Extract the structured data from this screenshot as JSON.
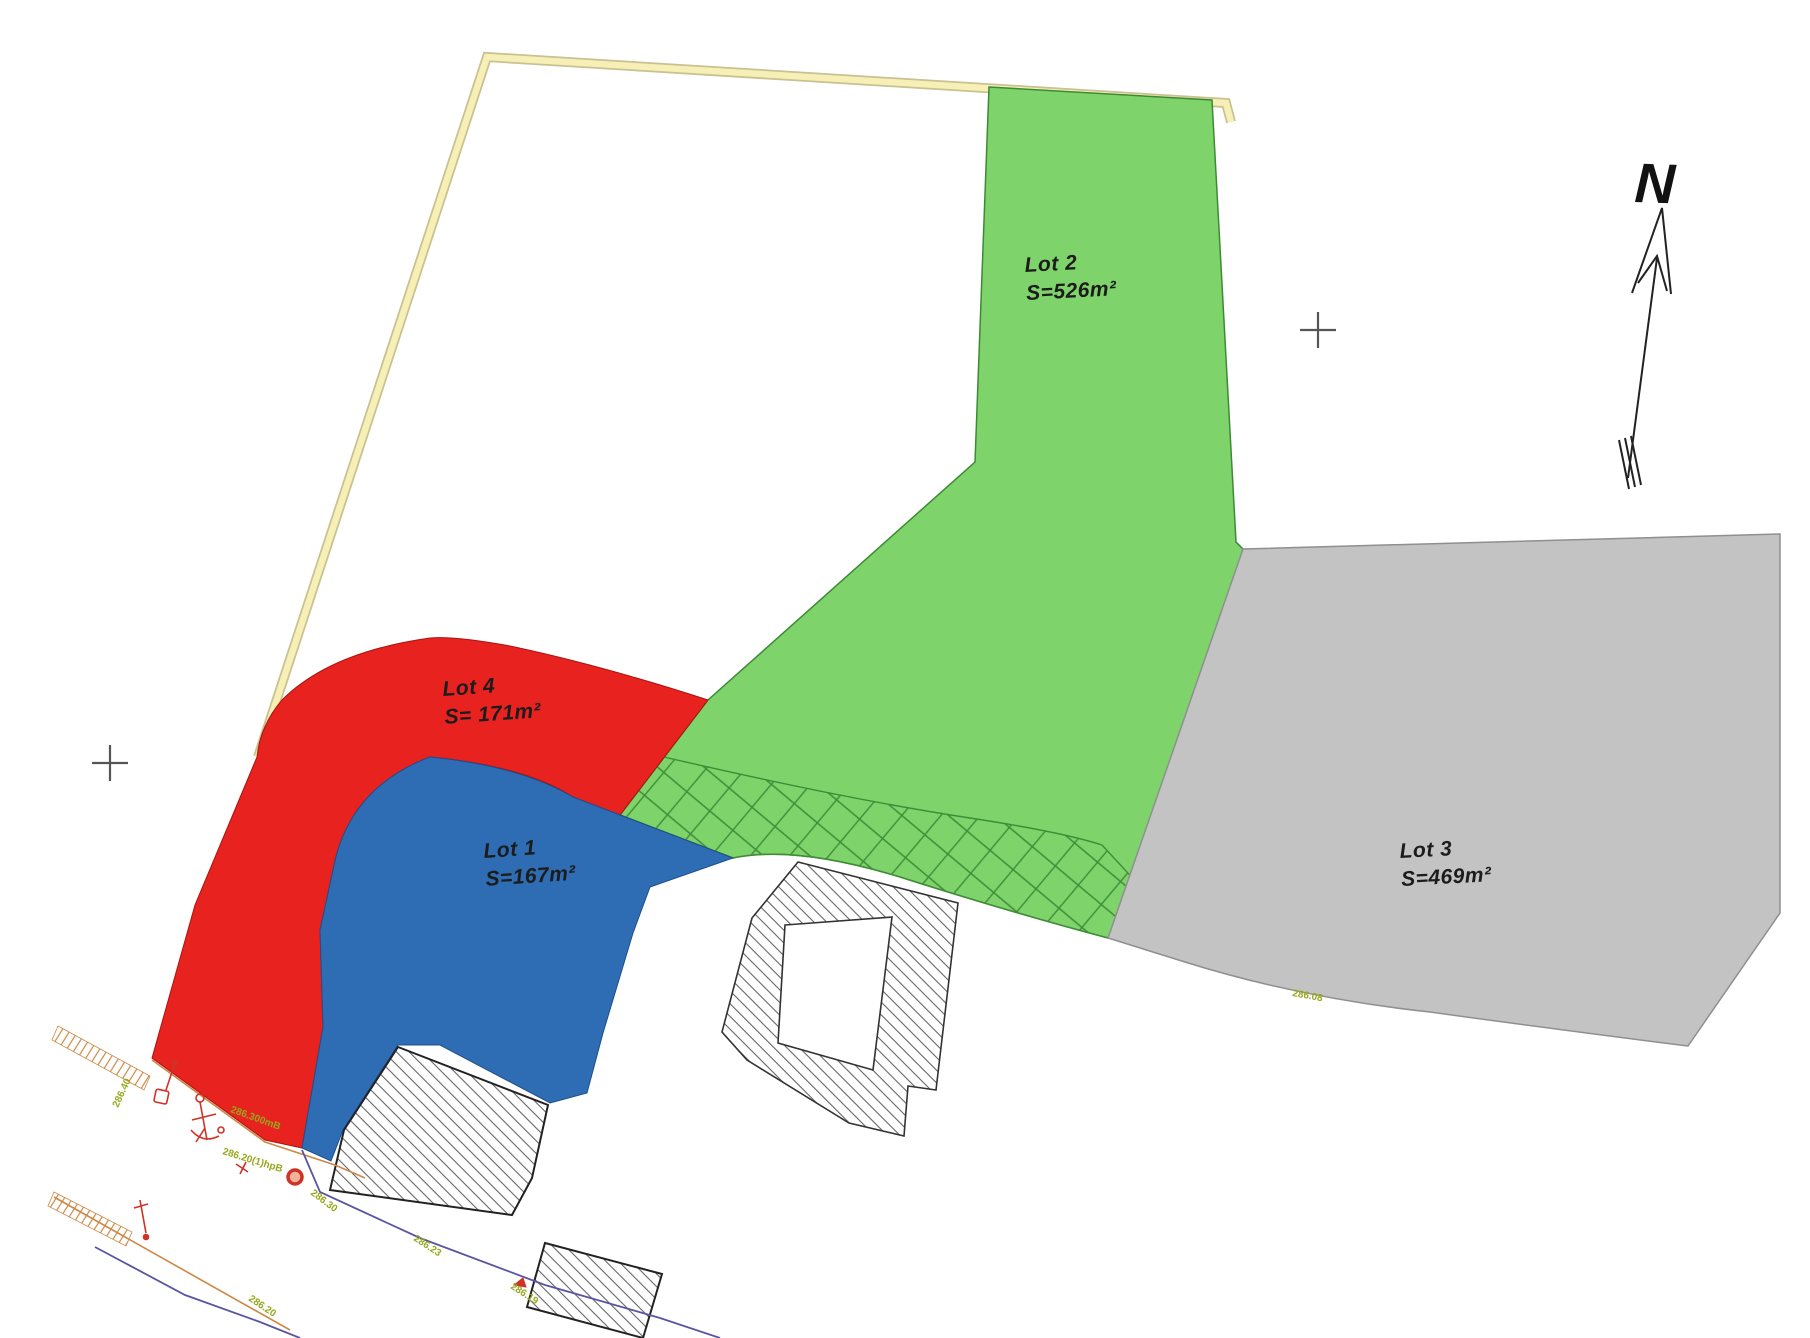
{
  "lots": [
    {
      "name": "Lot 1",
      "area": "S=167m²",
      "color": "#2e6db4"
    },
    {
      "name": "Lot 2",
      "area": "S=526m²",
      "color": "#7ed36b"
    },
    {
      "name": "Lot 3",
      "area": "S=469m²",
      "color": "#c3c3c3"
    },
    {
      "name": "Lot 4",
      "area": "S= 171m²",
      "color": "#e8221e"
    }
  ],
  "north": {
    "label": "N"
  },
  "elevations": [
    "286.40",
    "286.300mB",
    "286.20(1)hpB",
    "286.30",
    "286.23",
    "286.19",
    "286.20",
    "286.08"
  ],
  "colors": {
    "lot1_border": "#1d4f8c",
    "lot2_border": "#3d8a35",
    "lot3_border": "#8f8f8f",
    "lot4_border": "#a91510",
    "crosshatch": "#3f8c36",
    "boundary_band": "#f6efb6",
    "boundary_band_edge": "#c9c190",
    "wall_line": "#cc8844",
    "survey_polyline": "#5a55a0",
    "elevation_text": "#97a81c",
    "red_symbol": "#d03226",
    "building_hatch": "#666666",
    "building_outline": "#333333",
    "cross_mark": "#555555",
    "north_arrow": "#222222"
  }
}
